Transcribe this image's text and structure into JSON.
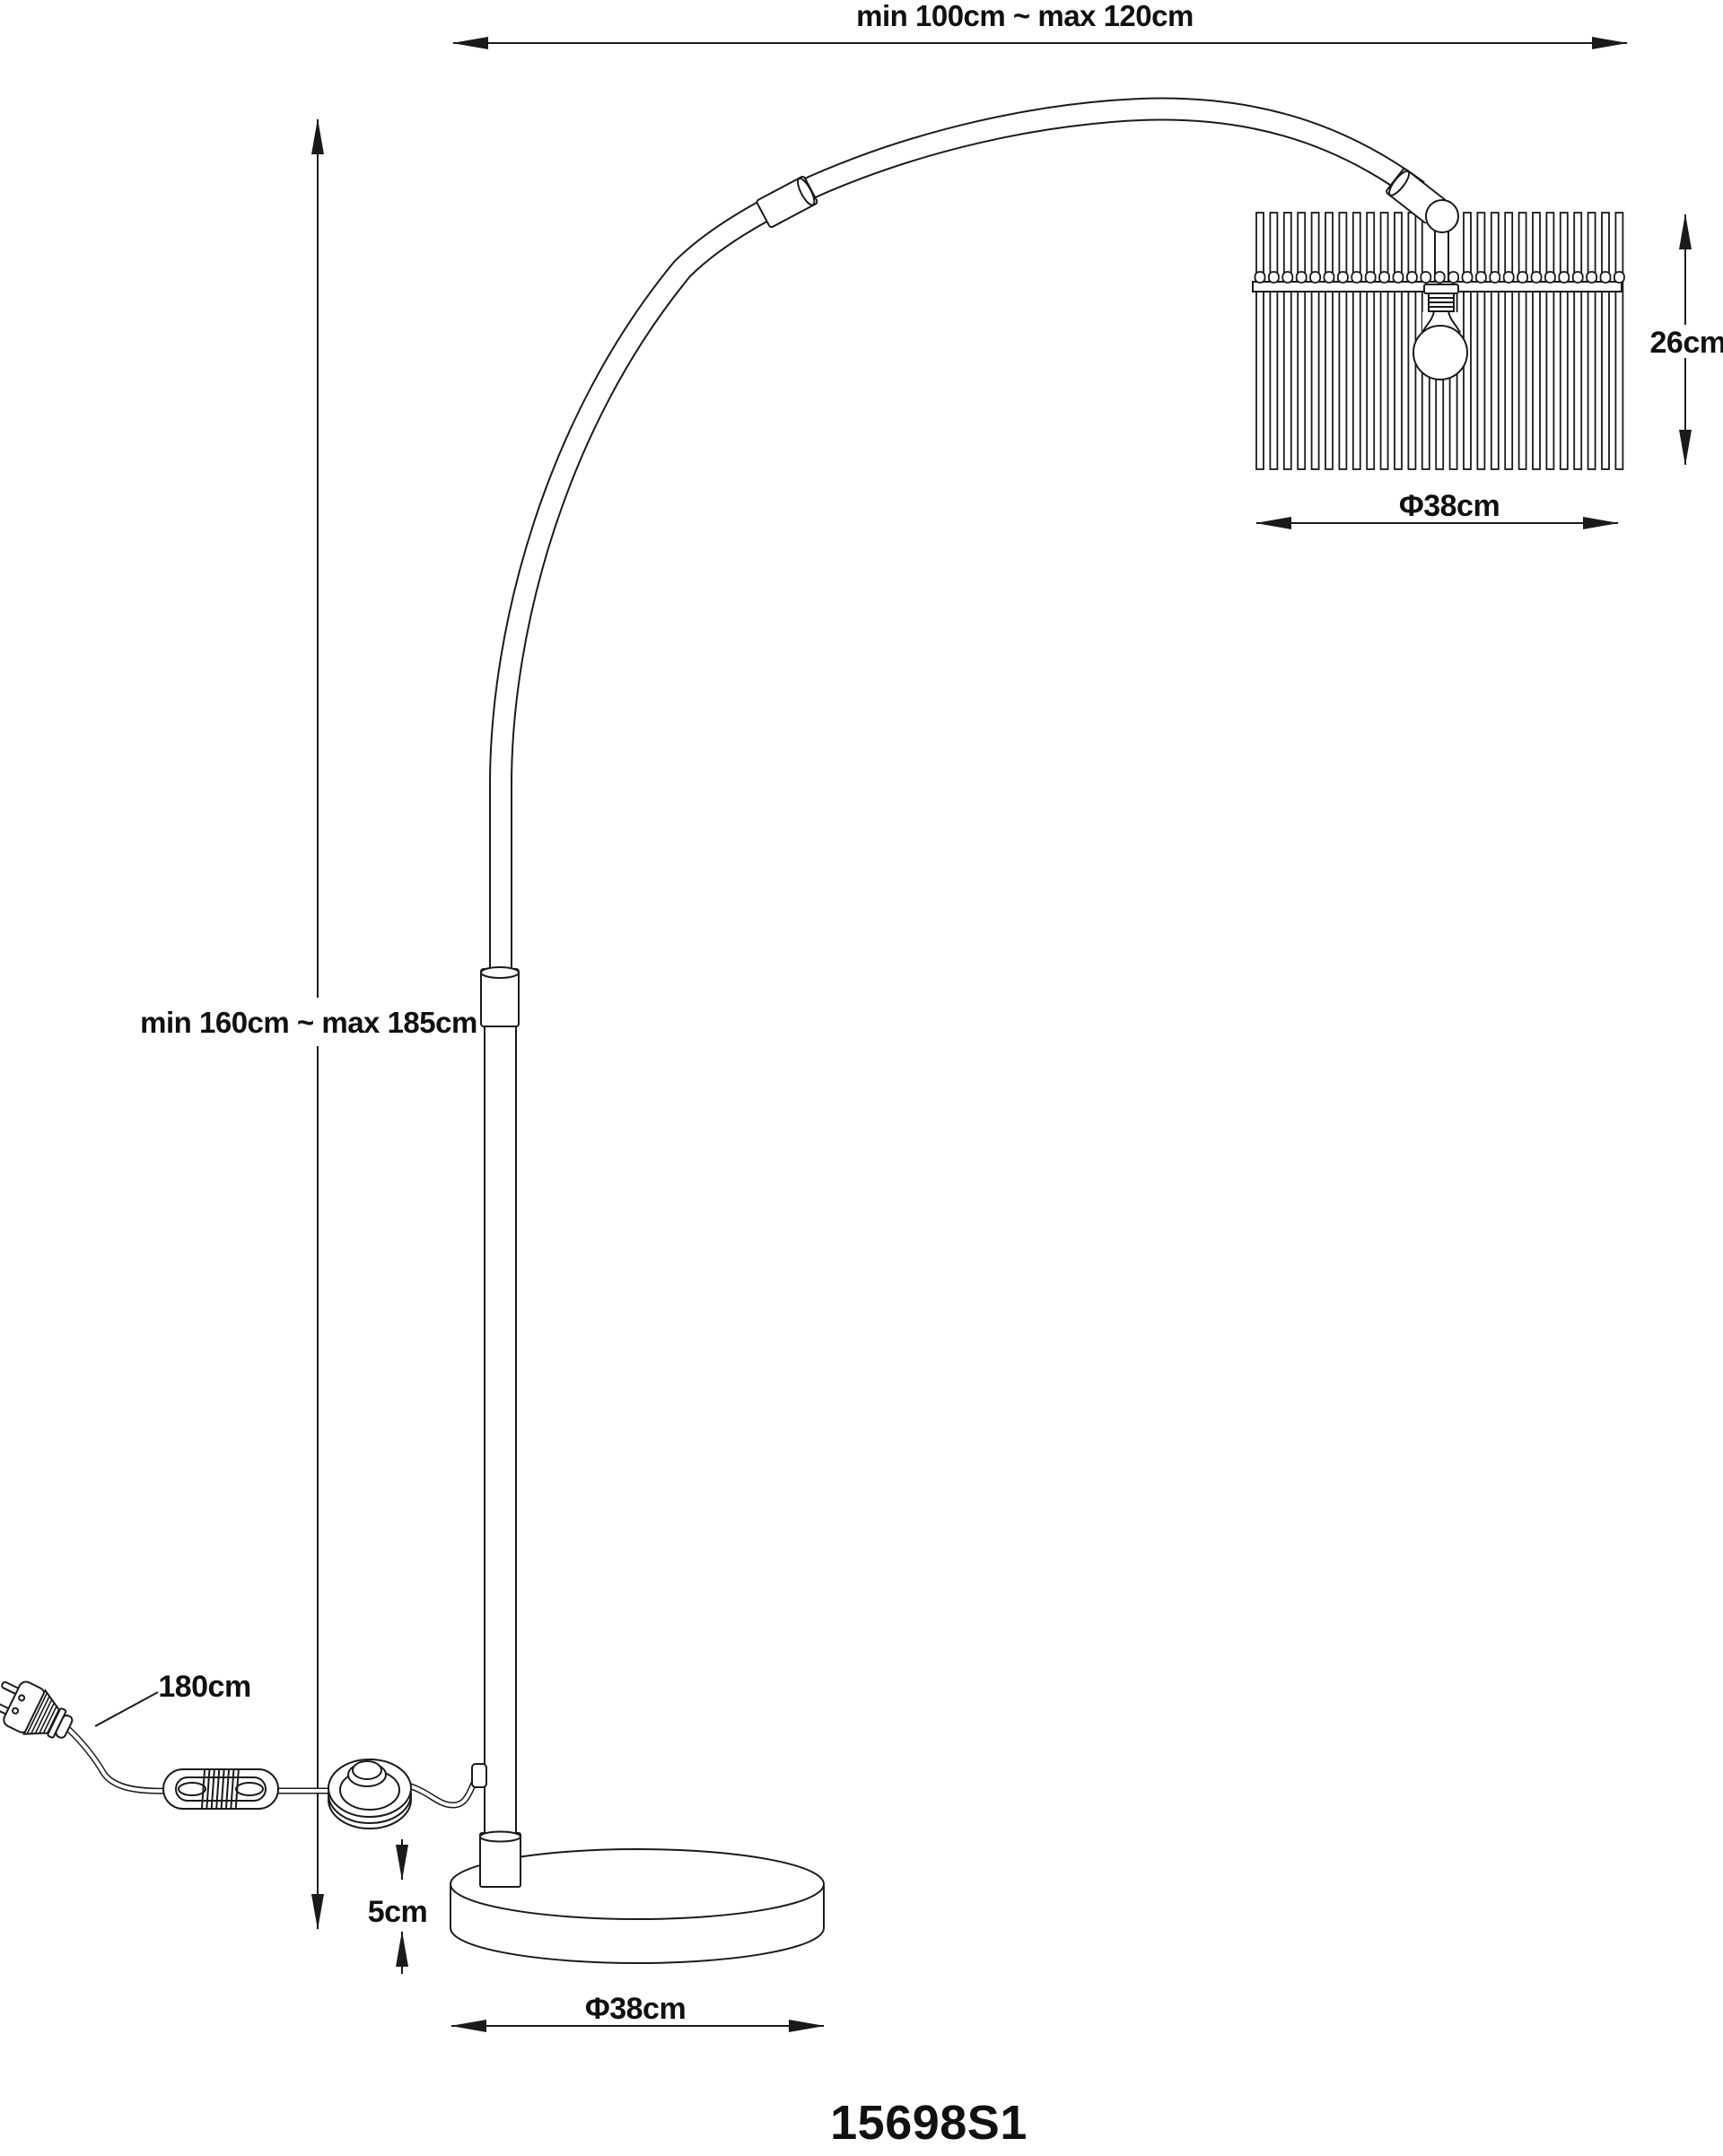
{
  "title": "Arc floor lamp dimension diagram",
  "colors": {
    "line": "#1a1a1a",
    "text": "#111111",
    "background": "#ffffff"
  },
  "dimensions": {
    "arm_reach": "min 100cm ~ max 120cm",
    "lamp_height": "min 160cm ~ max 185cm",
    "shade_height": "26cm",
    "shade_diameter": "Φ38cm",
    "cord_length": "180cm",
    "base_height": "5cm",
    "base_diameter": "Φ38cm"
  },
  "product_code": "15698S1"
}
